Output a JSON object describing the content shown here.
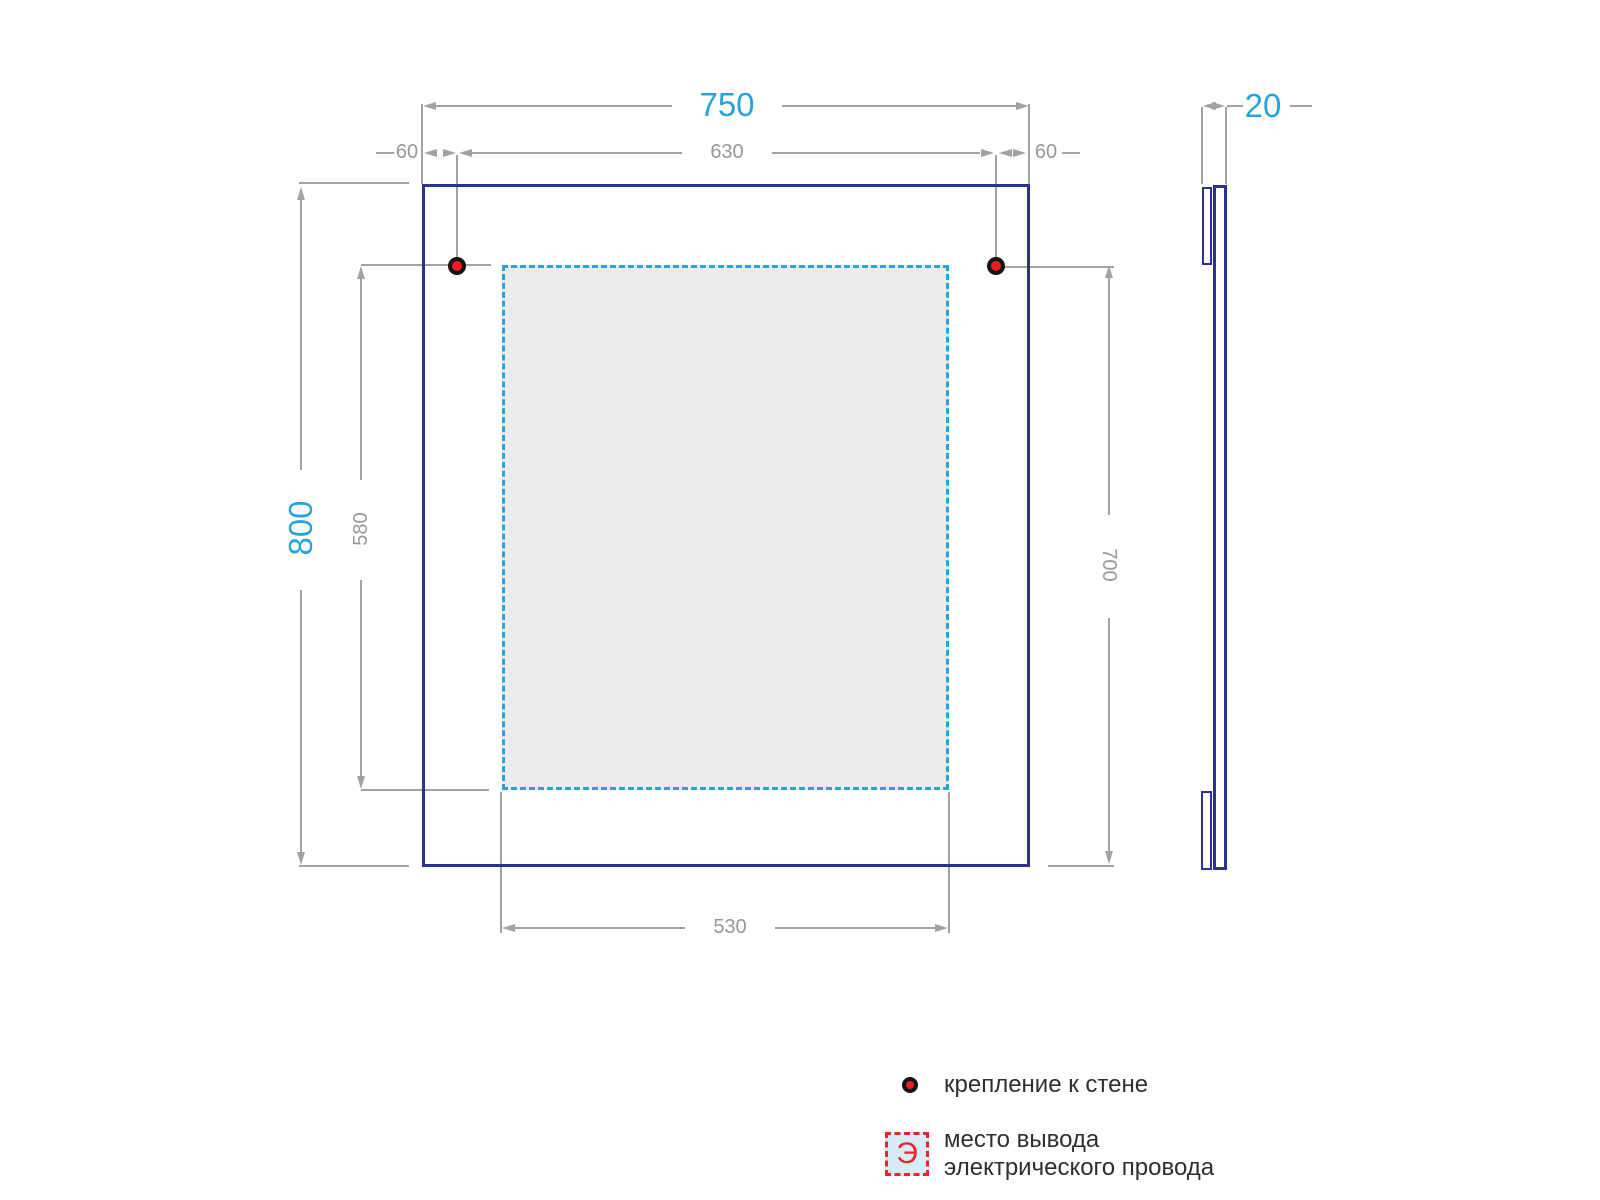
{
  "front_view": {
    "dims": {
      "overall_width": "750",
      "overall_height": "800",
      "mount_offset_left": "60",
      "mount_span": "630",
      "mount_offset_right": "60",
      "inner_height": "580",
      "right_drop": "700",
      "inner_width": "530"
    }
  },
  "side_view": {
    "thickness": "20"
  },
  "legend": {
    "mount_label": "крепление к стене",
    "outlet_symbol": "Э",
    "outlet_label_line1": "место вывода",
    "outlet_label_line2": "электрического провода"
  },
  "colors": {
    "mirror_outline": "#2e3192",
    "primary_dim": "#29a3dc",
    "secondary_dim": "#96989a",
    "mount_point": "#ed1c24",
    "outlet_zone_fill": "#ececee",
    "legend_square_fill": "#d8ecf8",
    "legend_red": "#e8262a"
  }
}
